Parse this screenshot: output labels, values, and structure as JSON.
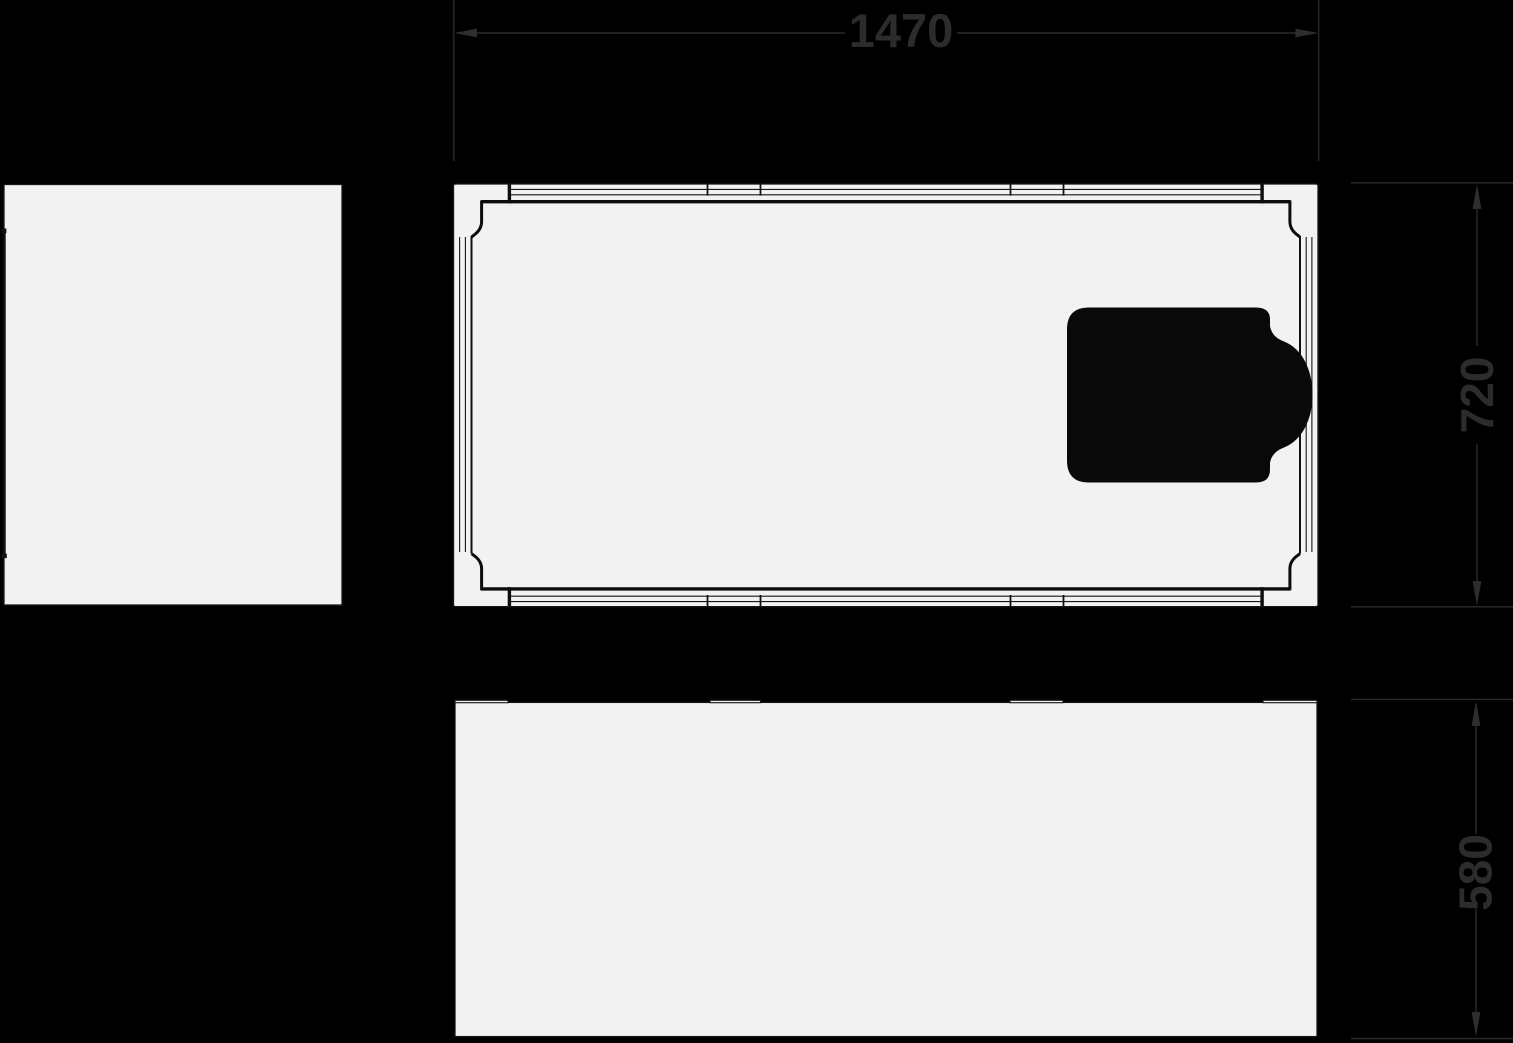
{
  "page": {
    "type": "bathtub technical dimension drawing",
    "background_color": "#000000"
  },
  "drawing": {
    "views": {
      "side_view": {
        "name": "end panel view"
      },
      "top_view": {
        "name": "plan view with headrest cushion"
      },
      "front_view": {
        "name": "front elevation view"
      }
    },
    "dimensions": {
      "width": {
        "label": "1470"
      },
      "depth": {
        "label": "720"
      },
      "height": {
        "label": "580"
      }
    },
    "colors": {
      "surface": "#f2f2f2",
      "line": "#161616",
      "thick_line": "#0c0c0c",
      "dimension_line": "#2a2a2a",
      "dimension_text": "#2c2c2c",
      "headrest": "#090909",
      "background": "#000000"
    }
  }
}
